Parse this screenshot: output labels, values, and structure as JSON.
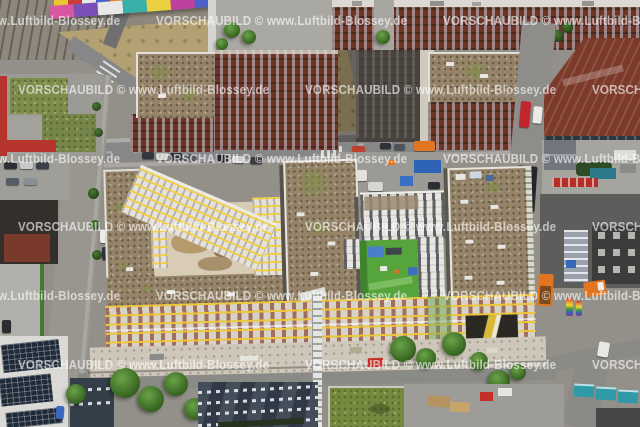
{
  "image": {
    "kind": "oblique aerial photograph",
    "subject": "large residential construction quarter with scaffolding and gravel flat roofs, surrounded by dark red brick office buildings, streets, a railway corridor with a graffiti wall, container yards and construction vehicles",
    "width_px": 640,
    "height_px": 427
  },
  "watermark": {
    "text": "VORSCHAUBILD © www.Luftbild-Blossey.de",
    "color": "#ffffff",
    "opacity": 0.62,
    "tiled": true,
    "x_period_px": 287,
    "y_period_px": 69,
    "rows": 6
  },
  "scene": {
    "regions": [
      {
        "name": "railway-corridor",
        "desc": "gray track bed, top left",
        "color": "#8e887c"
      },
      {
        "name": "graffiti-noise-wall",
        "desc": "colorful painted wall along the railway",
        "colors": [
          "#d857a0",
          "#7a4fb8",
          "#38b0a8",
          "#ecd040",
          "#cc3a3a",
          "#4a62c8",
          "#58b048",
          "#e88030"
        ]
      },
      {
        "name": "dry-brownfield",
        "desc": "dry scrub ground between railway and streets",
        "color": "#b3a173"
      },
      {
        "name": "brick-office-complex",
        "desc": "dark red brick office blocks, upper half",
        "color": "#6e3427"
      },
      {
        "name": "gravel-flat-roofs",
        "desc": "brown gravel roofs with moss patches",
        "color": "#96846a"
      },
      {
        "name": "dark-highrise-slab",
        "desc": "dark tower slab with light east face",
        "color": "#4a433d"
      },
      {
        "name": "maroon-hall",
        "desc": "large maroon metal roof hall, top right",
        "color": "#7c3a2b"
      },
      {
        "name": "construction-quarter",
        "desc": "four blocks under construction with scaffolded south facade",
        "colors": {
          "gravel_roof": "#96846a",
          "scaffold_yellow": "#eec836",
          "facade": "#d7d2c8",
          "dirt_courtyard": "#d8ccb6",
          "green_courtyard": "#55a43c",
          "banner": "#2b2722"
        }
      },
      {
        "name": "white-residential-u-block",
        "desc": "white building around green playground courtyard",
        "color": "#e8e6e1"
      },
      {
        "name": "tower-crane",
        "desc": "white crane mast, bottom center",
        "color": "#e4e4e2"
      },
      {
        "name": "streets",
        "desc": "asphalt streets with parked cars",
        "color": "#878787"
      },
      {
        "name": "moss-roof-building",
        "desc": "red-walled building with green moss roof, mid left",
        "colors": [
          "#b5352c",
          "#7e8c4c"
        ]
      },
      {
        "name": "gabled-apartment-roofs",
        "desc": "dark gabled roofs with dormer rows, bottom center",
        "color": "#39434f"
      },
      {
        "name": "sedum-green-roof",
        "desc": "green flat roof, bottom center right",
        "color": "#75893f"
      },
      {
        "name": "solar-panel-roofs",
        "desc": "rooftop solar arrays, bottom left",
        "color": "#1f2a38"
      },
      {
        "name": "container-yards",
        "desc": "shipping containers and site huts",
        "colors": [
          "#2f63b8",
          "#2f9aa8",
          "#c23028",
          "#b5925e"
        ]
      },
      {
        "name": "orange-construction-vehicles",
        "desc": "orange trucks and machines, right side",
        "color": "#e2751f"
      },
      {
        "name": "fire-truck",
        "desc": "red emergency vehicle on side street, top right",
        "color": "#c2262c"
      }
    ]
  }
}
